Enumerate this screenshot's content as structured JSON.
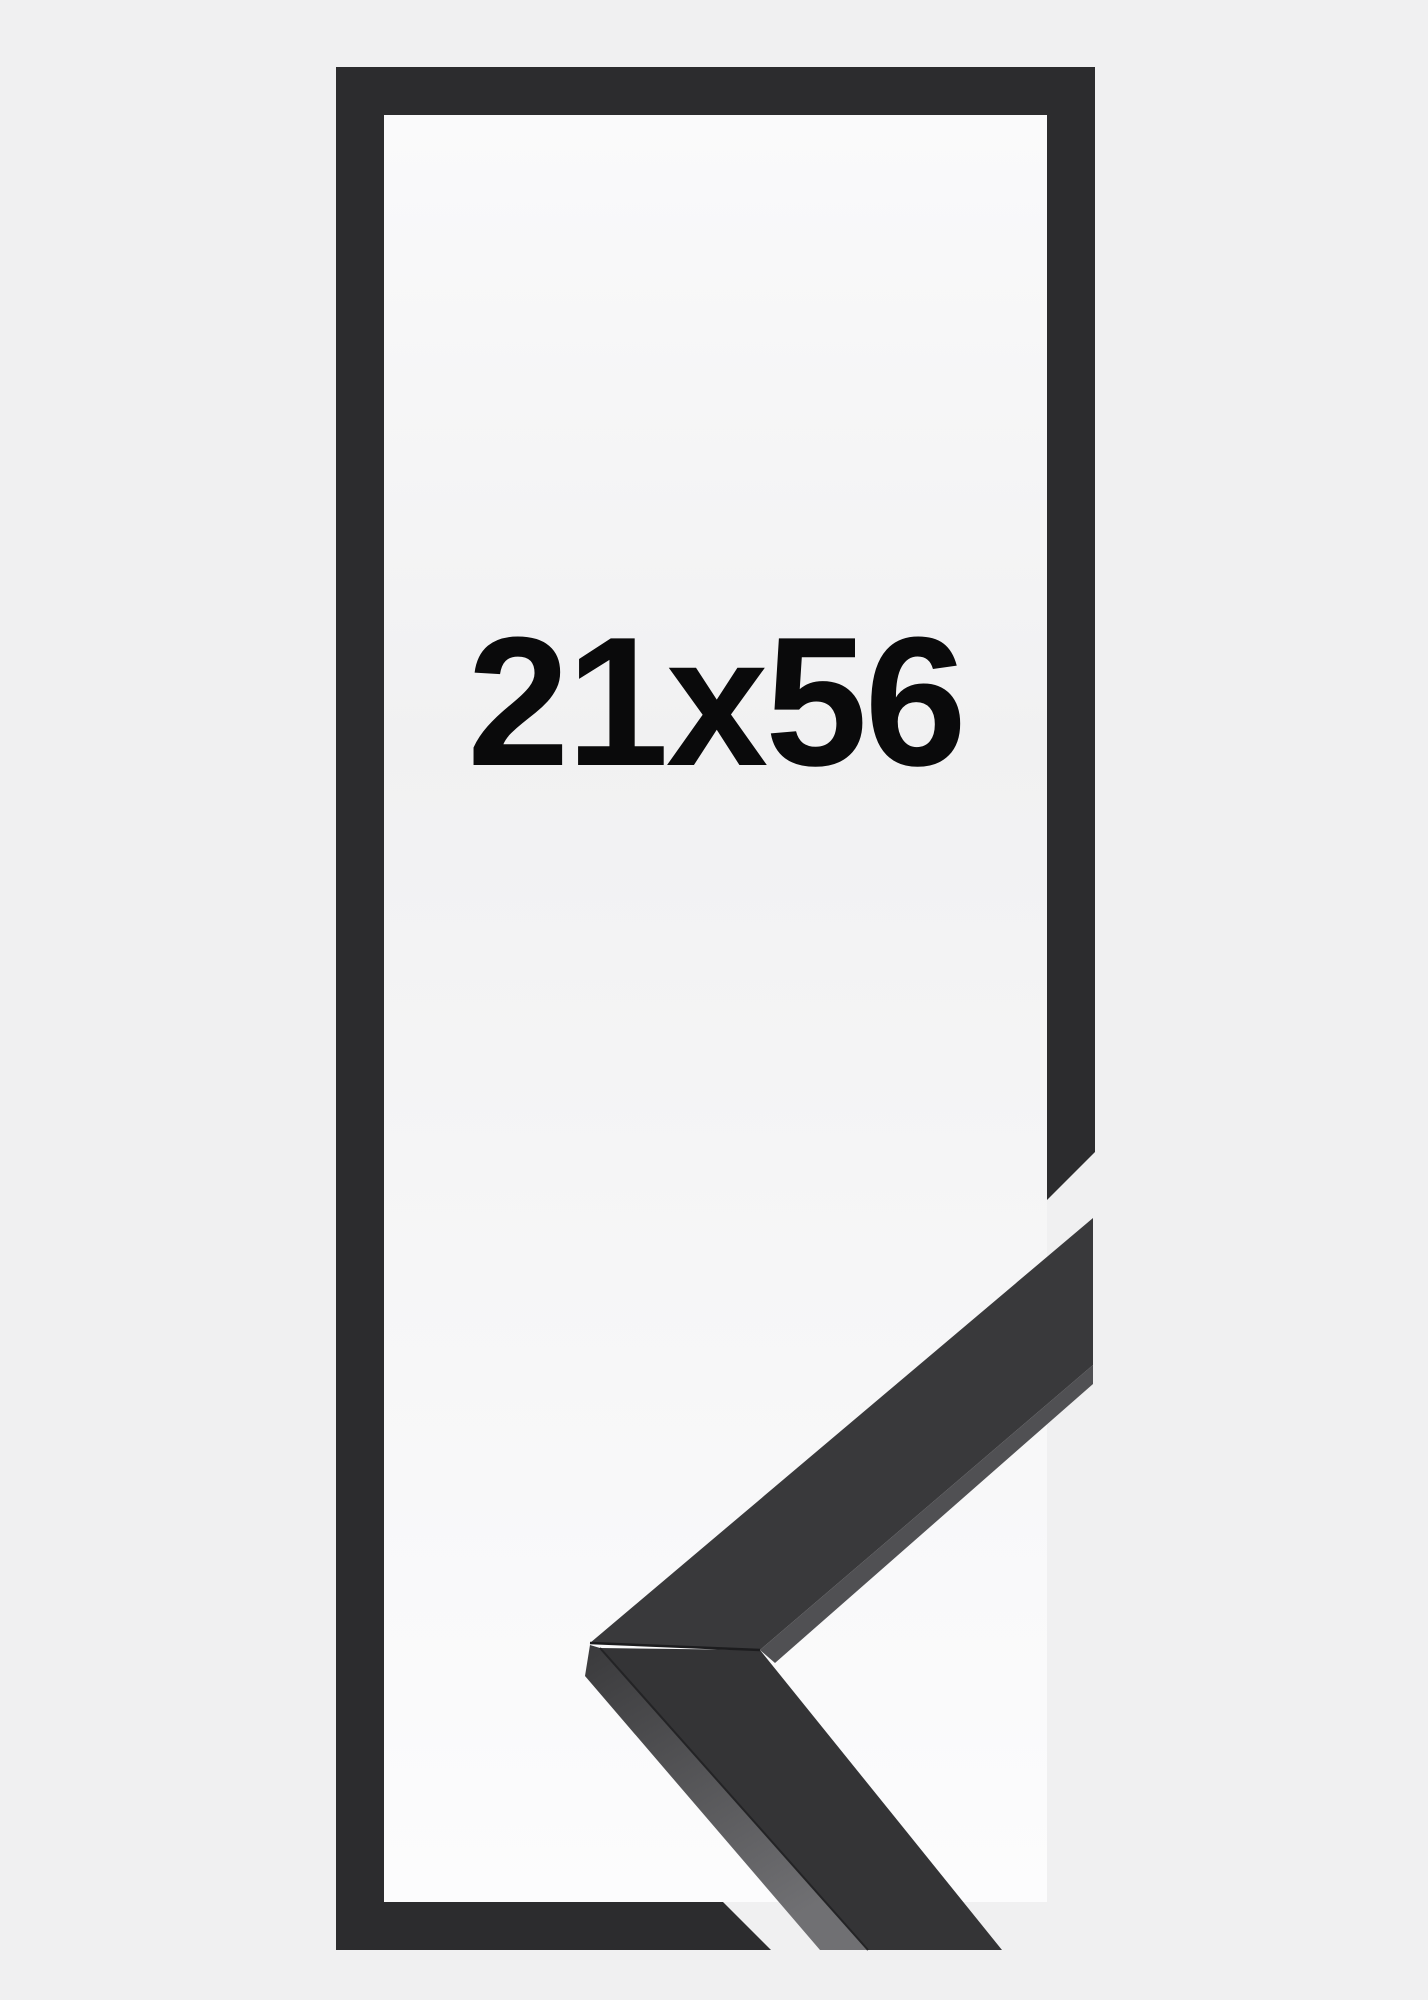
{
  "product": {
    "size_label": "21x56"
  },
  "colors": {
    "background": "#f0f0f1",
    "panel_top": "#fafafb",
    "panel_mid": "#f1f1f2",
    "panel_bottom": "#fcfcfd",
    "frame_dark": "#2c2c2e",
    "arm_upper_face": "#39393b",
    "arm_lower_face": "#343436",
    "side_face_top": "#3a3a3c",
    "side_face_bottom": "#707073",
    "rabbet_sliver": "#505053",
    "seam_line": "#1c1c1e",
    "edge_line": "#232325",
    "label_text": "#0a0a0b"
  }
}
